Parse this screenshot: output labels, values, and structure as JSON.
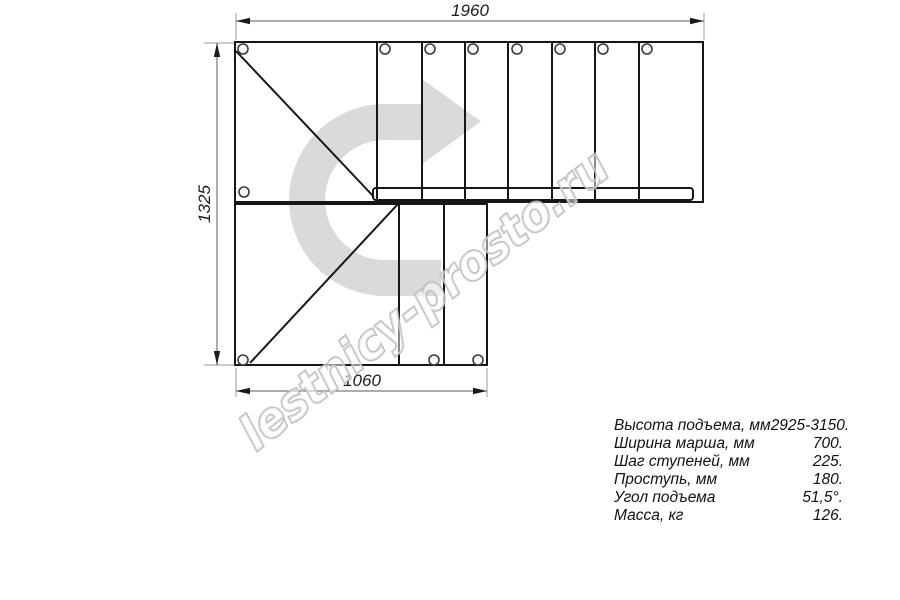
{
  "drawing": {
    "title": "L-shaped staircase plan drawing",
    "dim_top": "1960",
    "dim_left": "1325",
    "dim_bottom": "1060",
    "watermark": "lestnicy-prosto.ru"
  },
  "specs": {
    "rows": [
      {
        "label": "Высота подъема, мм",
        "value": "2925-3150."
      },
      {
        "label": "Ширина марша, мм",
        "value": "700."
      },
      {
        "label": "Шаг ступеней, мм",
        "value": "225."
      },
      {
        "label": "Проступь, мм",
        "value": "180."
      },
      {
        "label": "Угол подъема",
        "value": "51,5°."
      },
      {
        "label": "Масса, кг",
        "value": "126."
      }
    ]
  },
  "colors": {
    "line": "#161616",
    "dimension_line": "#5a5a5a",
    "extension_line": "#9a9a9a",
    "hole_stroke": "#3a3a3a",
    "arrow_watermark": "#d7d7d7",
    "watermark_outline": "#b5b5b5",
    "background": "#ffffff"
  }
}
